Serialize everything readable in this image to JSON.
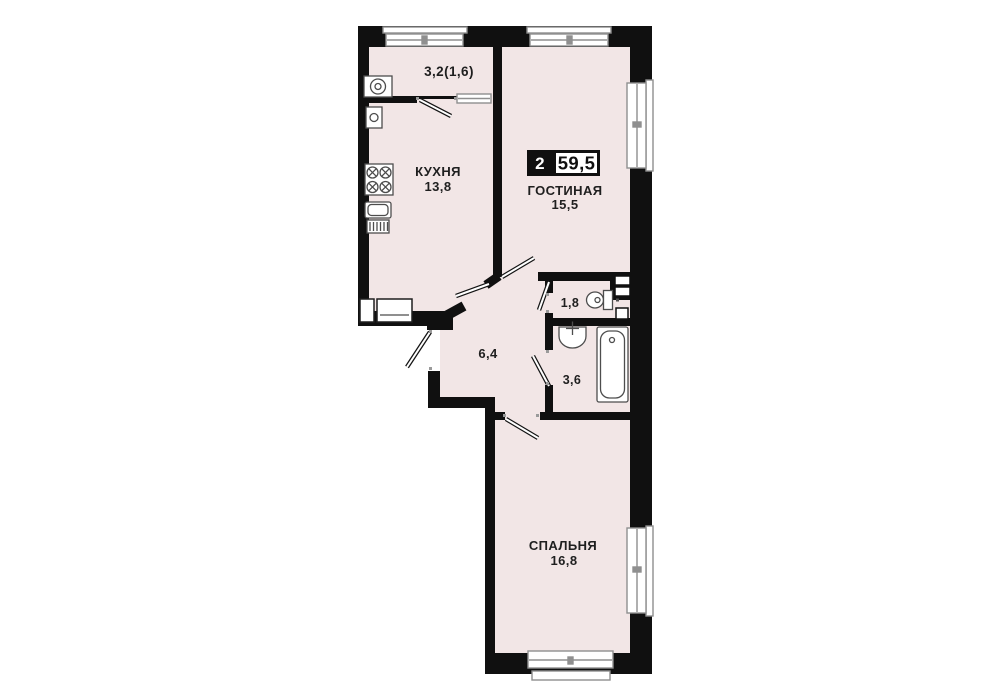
{
  "plan": {
    "type_badge": {
      "rooms_count": "2",
      "total_area": "59,5"
    },
    "rooms": [
      {
        "key": "balcony",
        "label": "",
        "area_label": "3,2(1,6)"
      },
      {
        "key": "kitchen",
        "label": "КУХНЯ",
        "area_label": "13,8"
      },
      {
        "key": "living_room",
        "label": "ГОСТИНАЯ",
        "area_label": "15,5"
      },
      {
        "key": "hallway",
        "label": "",
        "area_label": "6,4"
      },
      {
        "key": "wc",
        "label": "",
        "area_label": "1,8"
      },
      {
        "key": "bathroom",
        "label": "",
        "area_label": "3,6"
      },
      {
        "key": "bedroom",
        "label": "СПАЛЬНЯ",
        "area_label": "16,8"
      }
    ],
    "fixtures": [
      "washing-machine-icon",
      "boiler-icon",
      "stove-icon",
      "kitchen-sink-icon",
      "toilet-icon",
      "bathroom-sink-icon",
      "bathtub-icon"
    ],
    "colors": {
      "background": "#ffffff",
      "room_fill": "#f2e6e6",
      "wall": "#101010",
      "window_frame": "#8f8f8f",
      "fixture_stroke": "#4d4d4d",
      "text": "#1f1f1f",
      "badge_bg": "#101010",
      "badge_text_on_dark": "#ffffff"
    }
  }
}
